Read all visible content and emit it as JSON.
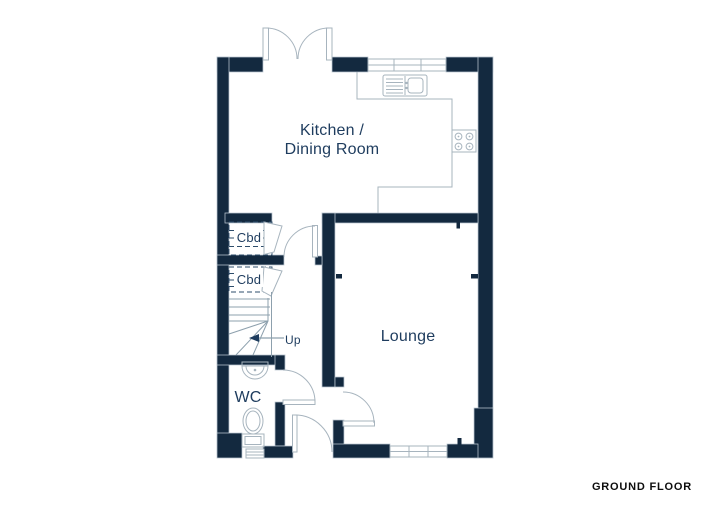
{
  "plan": {
    "labels": {
      "kitchen_line1": "Kitchen /",
      "kitchen_line2": "Dining Room",
      "lounge": "Lounge",
      "wc": "WC",
      "cupboard_1": "Cbd",
      "cupboard_2": "Cbd",
      "stairs_direction": "Up",
      "floor": "GROUND FLOOR"
    },
    "icons": [
      "french-doors-icon",
      "door-swing-icon",
      "window-icon",
      "sink-icon",
      "hob-icon",
      "counter-icon",
      "stairs-icon",
      "up-arrow-icon",
      "basin-icon",
      "toilet-icon"
    ],
    "colors": {
      "wall": "#13293f",
      "wall_outline": "#bcc8d2",
      "thin_line": "#a7b4be",
      "dashed_line": "#2e4d6b",
      "label_text": "#1e3c5e",
      "floor_label_text": "#0d0d0d",
      "background": "#ffffff"
    }
  }
}
